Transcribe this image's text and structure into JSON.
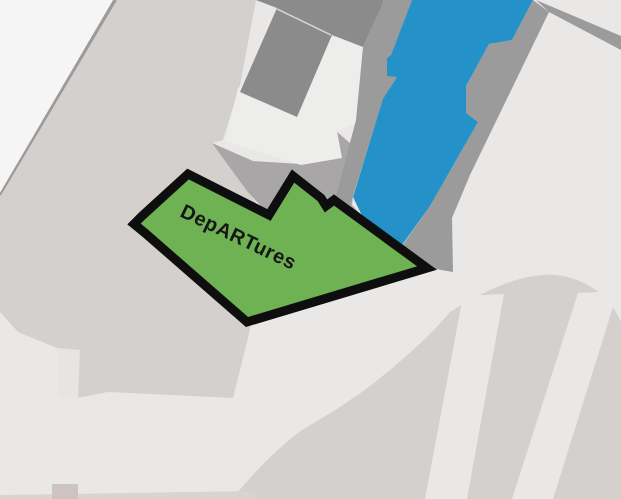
{
  "map": {
    "type": "aerial-venue-map",
    "zone": {
      "label": "DepARTures",
      "fill": "#6fb253",
      "outline": "#0e0e0e",
      "label_color": "#161616"
    },
    "colors": {
      "background": "#e9e8e7",
      "open_area_white": "#f6f5f5",
      "ground_beige": "#d4d0ce",
      "ground_beige_bottom": "#d9d3d1",
      "building_white": "#ededec",
      "building_dark": "#8b8b8b",
      "pier_gray": "#9c9b9b",
      "apron_gray": "#a8a6a6",
      "wedge_light": "#d9d8d8",
      "water_blue": "#2492c8",
      "road_light": "#e9e8e7",
      "small_block": "#cdc4c1",
      "boundary_line": "#9c9a9a",
      "roof_seam": "#d9d8d8",
      "notch_light": "#e6e5e4"
    }
  }
}
